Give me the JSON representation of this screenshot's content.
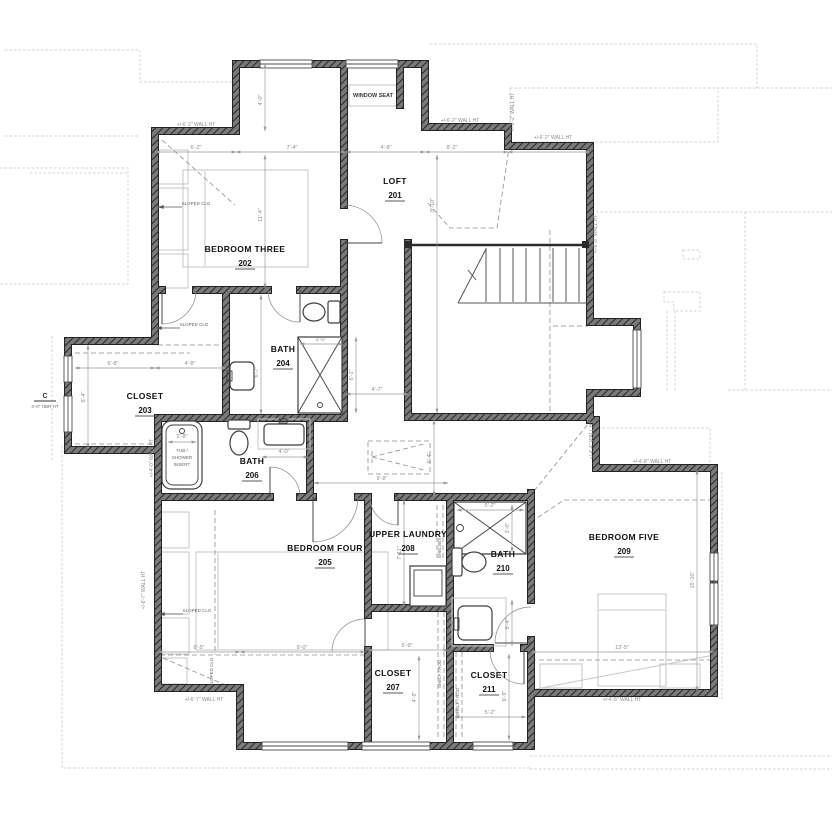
{
  "drawing": {
    "type": "second-floor residential plan",
    "colors": {
      "wall": "#3d3d3d",
      "dimension_text": "#8c8c8c",
      "roof_outline": "#d2d2d2",
      "room_text": "#111111"
    }
  },
  "rooms": [
    {
      "name": "LOFT",
      "number": "201",
      "x": 395,
      "y": 184
    },
    {
      "name": "BEDROOM THREE",
      "number": "202",
      "x": 245,
      "y": 252
    },
    {
      "name": "CLOSET",
      "number": "203",
      "x": 145,
      "y": 399
    },
    {
      "name": "BATH",
      "number": "204",
      "x": 283,
      "y": 352
    },
    {
      "name": "BEDROOM FOUR",
      "number": "205",
      "x": 325,
      "y": 551
    },
    {
      "name": "BATH",
      "number": "206",
      "x": 252,
      "y": 464
    },
    {
      "name": "CLOSET",
      "number": "207",
      "x": 393,
      "y": 676
    },
    {
      "name": "UPPER LAUNDRY",
      "number": "208",
      "x": 408,
      "y": 537
    },
    {
      "name": "BEDROOM FIVE",
      "number": "209",
      "x": 624,
      "y": 540
    },
    {
      "name": "BATH",
      "number": "210",
      "x": 503,
      "y": 557
    },
    {
      "name": "CLOSET",
      "number": "211",
      "x": 489,
      "y": 678
    }
  ],
  "dimensions": [
    {
      "t": "6'-2\"",
      "x": 196,
      "y": 149
    },
    {
      "t": "7'-4\"",
      "x": 292,
      "y": 149
    },
    {
      "t": "4'-8\"",
      "x": 386,
      "y": 149
    },
    {
      "t": "8'-2\"",
      "x": 452,
      "y": 149
    },
    {
      "t": "6'-2\"",
      "x": 549,
      "y": 149
    },
    {
      "t": "4'-0\"",
      "x": 262,
      "y": 100,
      "r": 1
    },
    {
      "t": "11'-4\"",
      "x": 262,
      "y": 215,
      "r": 1
    },
    {
      "t": "8'-10\"",
      "x": 434,
      "y": 205,
      "r": 1
    },
    {
      "t": "6'-8\"",
      "x": 113,
      "y": 365
    },
    {
      "t": "4'-8\"",
      "x": 190,
      "y": 365
    },
    {
      "t": "6'-4\"",
      "x": 85,
      "y": 397,
      "r": 1
    },
    {
      "t": "3'-0\"",
      "x": 321,
      "y": 341
    },
    {
      "t": "6'-1\"",
      "x": 353,
      "y": 375,
      "r": 1
    },
    {
      "t": "6'-7\"",
      "x": 258,
      "y": 372,
      "r": 1
    },
    {
      "t": "4'-0\"",
      "x": 284,
      "y": 453
    },
    {
      "t": "2'-8\"",
      "x": 182,
      "y": 438
    },
    {
      "t": "4'-7\"",
      "x": 377,
      "y": 391
    },
    {
      "t": "9'-8\"",
      "x": 382,
      "y": 480
    },
    {
      "t": "5'-4\"",
      "x": 431,
      "y": 458,
      "r": 1
    },
    {
      "t": "8'-5\"",
      "x": 199,
      "y": 649
    },
    {
      "t": "9'-0\"",
      "x": 302,
      "y": 649
    },
    {
      "t": "7'-11\"",
      "x": 401,
      "y": 553,
      "r": 1
    },
    {
      "t": "5'-2\"",
      "x": 490,
      "y": 507
    },
    {
      "t": "3'-0\"",
      "x": 509,
      "y": 528,
      "r": 1
    },
    {
      "t": "5'-4\"",
      "x": 509,
      "y": 624,
      "r": 1
    },
    {
      "t": "13'-5\"",
      "x": 622,
      "y": 649
    },
    {
      "t": "15'-10\"",
      "x": 694,
      "y": 580,
      "r": 1
    },
    {
      "t": "5'-9\"",
      "x": 407,
      "y": 647
    },
    {
      "t": "4'-9\"",
      "x": 416,
      "y": 697,
      "r": 1
    },
    {
      "t": "5'-2\"",
      "x": 490,
      "y": 714
    },
    {
      "t": "6'-9\"",
      "x": 506,
      "y": 696,
      "r": 1
    }
  ],
  "wall_heights": [
    {
      "t": "+/-6'-2\" WALL HT",
      "x": 196,
      "y": 126
    },
    {
      "t": "+/-6'-2\" WALL HT",
      "x": 460,
      "y": 122
    },
    {
      "t": "+/-6'-2\" WALL HT",
      "x": 553,
      "y": 139
    },
    {
      "t": "+/-6'-2\" WALL HT",
      "x": 514,
      "y": 112,
      "r": 1
    },
    {
      "t": "+/-6'-8\" WALL HT",
      "x": 597,
      "y": 234,
      "r": 1
    },
    {
      "t": "+/-6'-7\" WALL HT",
      "x": 145,
      "y": 590,
      "r": 1
    },
    {
      "t": "+/-6'-7\" WALL HT",
      "x": 204,
      "y": 701
    },
    {
      "t": "+/-4'-4\" WALL HT",
      "x": 593,
      "y": 440,
      "r": 1
    },
    {
      "t": "+/-4'-8\" WALL HT",
      "x": 652,
      "y": 463
    },
    {
      "t": "+/-4'-8\" WALL HT",
      "x": 622,
      "y": 701
    },
    {
      "t": "+/-4'-0\" WALL HT",
      "x": 153,
      "y": 458,
      "r": 1
    }
  ],
  "features": [
    {
      "t": "WINDOW SEAT",
      "x": 373,
      "y": 97,
      "cls": "feat"
    },
    {
      "t": "TUB /",
      "x": 182,
      "y": 452,
      "cls": "tiny"
    },
    {
      "t": "SHOWER",
      "x": 182,
      "y": 459,
      "cls": "tiny"
    },
    {
      "t": "INSERT",
      "x": 182,
      "y": 466,
      "cls": "tiny"
    },
    {
      "t": "SHELVES",
      "x": 441,
      "y": 548,
      "r": 1,
      "cls": "tiny"
    },
    {
      "t": "SHELF / ROD",
      "x": 441,
      "y": 674,
      "r": 1,
      "cls": "tiny"
    },
    {
      "t": "SHELF / ROD",
      "x": 459,
      "y": 702,
      "r": 1,
      "cls": "tiny"
    },
    {
      "t": "SLOPED CLG",
      "x": 196,
      "y": 205,
      "cls": "tiny"
    },
    {
      "t": "SLOPED CLG",
      "x": 194,
      "y": 326,
      "cls": "tiny"
    },
    {
      "t": "SLOPED CLG",
      "x": 197,
      "y": 612,
      "cls": "tiny"
    },
    {
      "t": "SLOPED CLG",
      "x": 213,
      "y": 672,
      "r": 1,
      "cls": "tiny"
    },
    {
      "t": "C",
      "x": 45,
      "y": 398,
      "cls": "marker"
    },
    {
      "t": "4'-0\" HDR HT",
      "x": 45,
      "y": 408,
      "cls": "tiny"
    }
  ]
}
